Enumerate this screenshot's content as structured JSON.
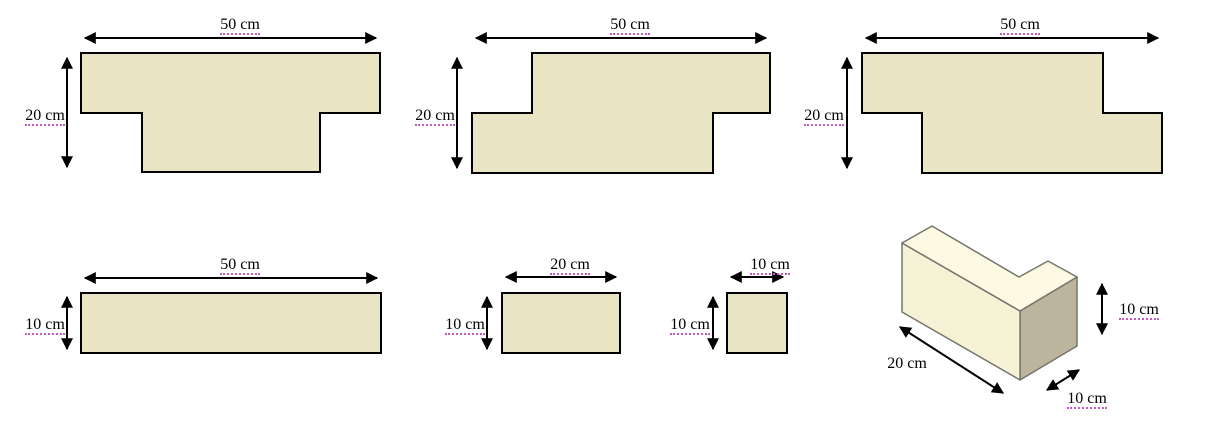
{
  "canvas": {
    "width": 1213,
    "height": 425,
    "background": "#ffffff"
  },
  "colors": {
    "shape_fill": "#e9e5c4",
    "shape_outline": "#000000",
    "arrow": "#000000",
    "label_underline": "#c45ac4",
    "block_top_face": "#fcfae2",
    "block_front_face": "#f6f2d6",
    "block_side_face": "#bcb49c",
    "block_edge": "#75756e"
  },
  "figures": {
    "tee": {
      "width": "50 cm",
      "height": "20 cm"
    },
    "zee_right": {
      "width": "50 cm",
      "height": "20 cm"
    },
    "zee_left": {
      "width": "50 cm",
      "height": "20 cm"
    },
    "bar_50": {
      "width": "50 cm",
      "height": "10 cm"
    },
    "bar_20": {
      "width": "20 cm",
      "height": "10 cm"
    },
    "square_10": {
      "width": "10 cm",
      "height": "10 cm"
    },
    "block_3d": {
      "length": "20 cm",
      "height": "10 cm",
      "depth": "10 cm"
    }
  }
}
